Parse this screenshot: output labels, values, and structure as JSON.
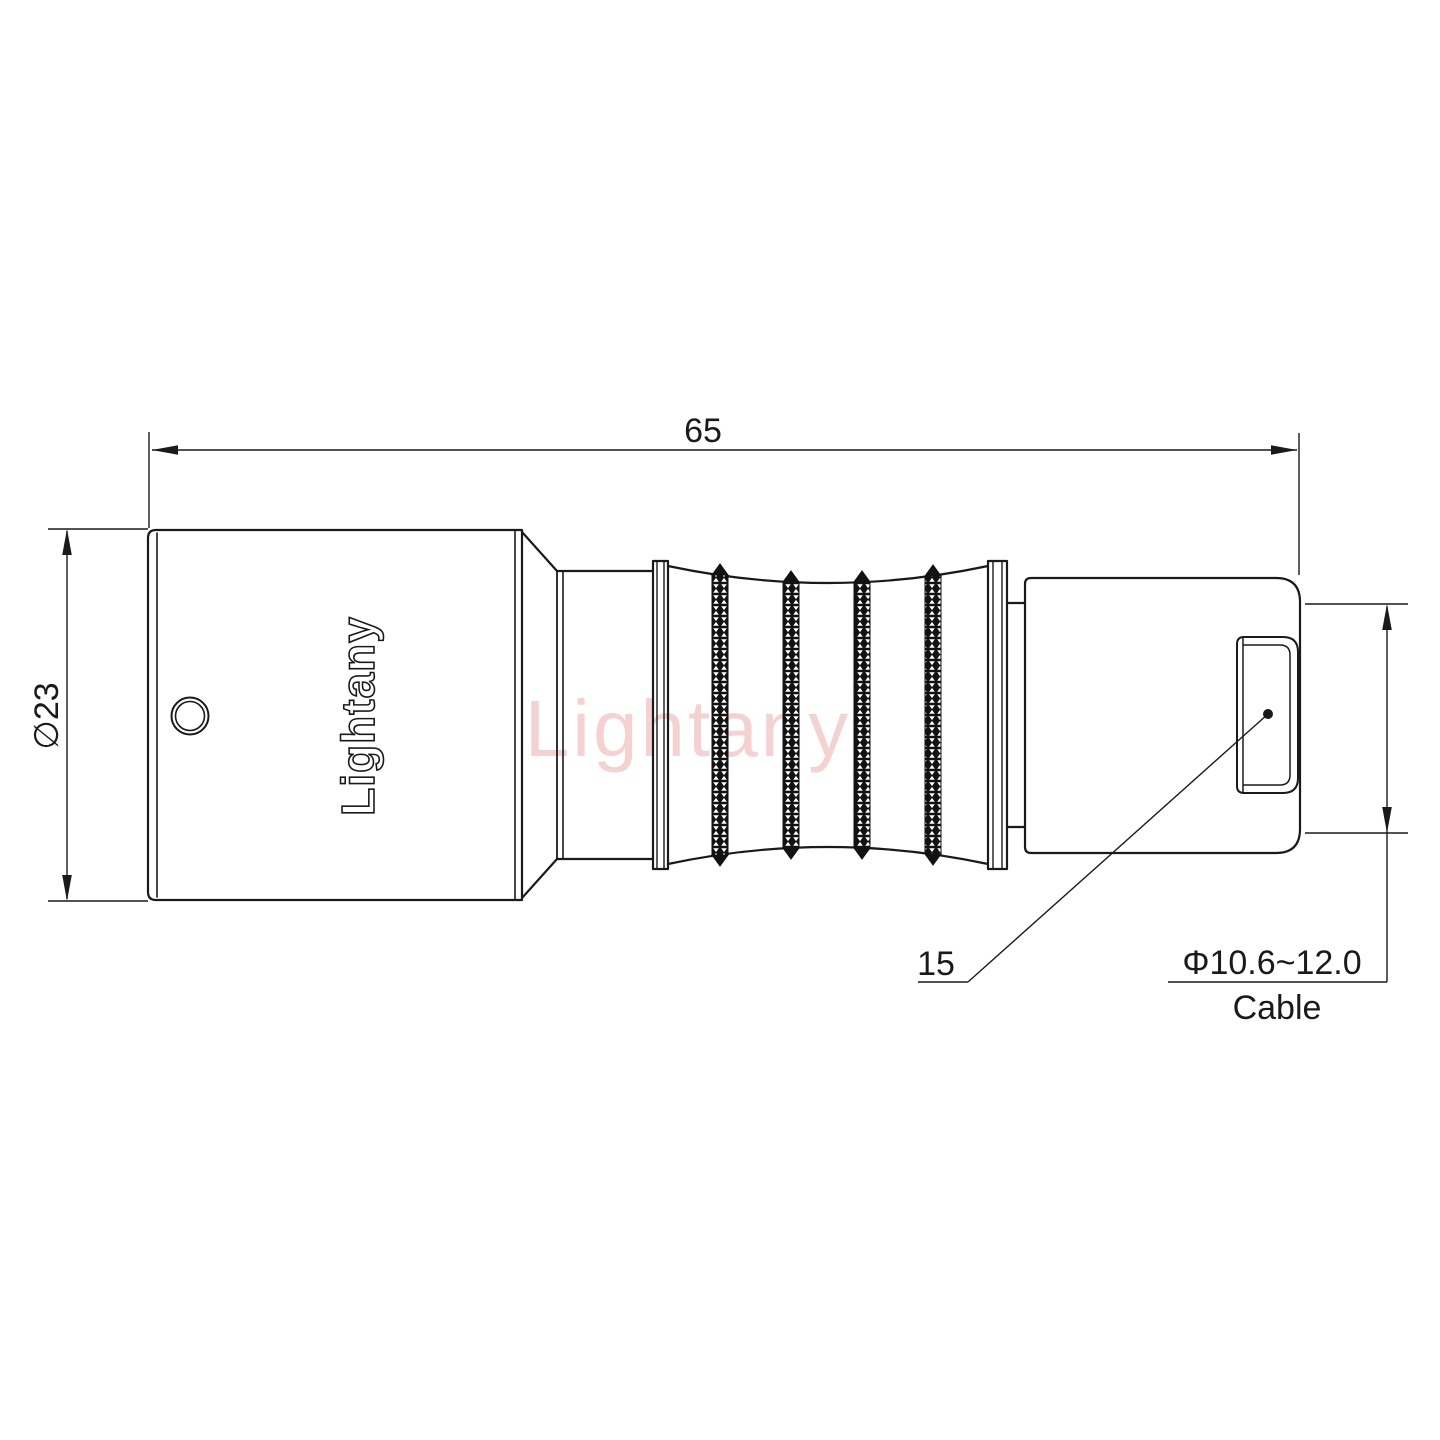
{
  "drawing": {
    "background_color": "#ffffff",
    "line_color": "#1a1a1a",
    "watermark": {
      "text": "Lightany",
      "color": "#eaa6a6"
    },
    "engraving": {
      "text": "Lightany"
    },
    "dimensions": {
      "overall_length": "65",
      "body_diameter": "∅23",
      "nut_length": "15",
      "cable_range": "Φ10.6~12.0",
      "cable_label": "Cable"
    }
  }
}
